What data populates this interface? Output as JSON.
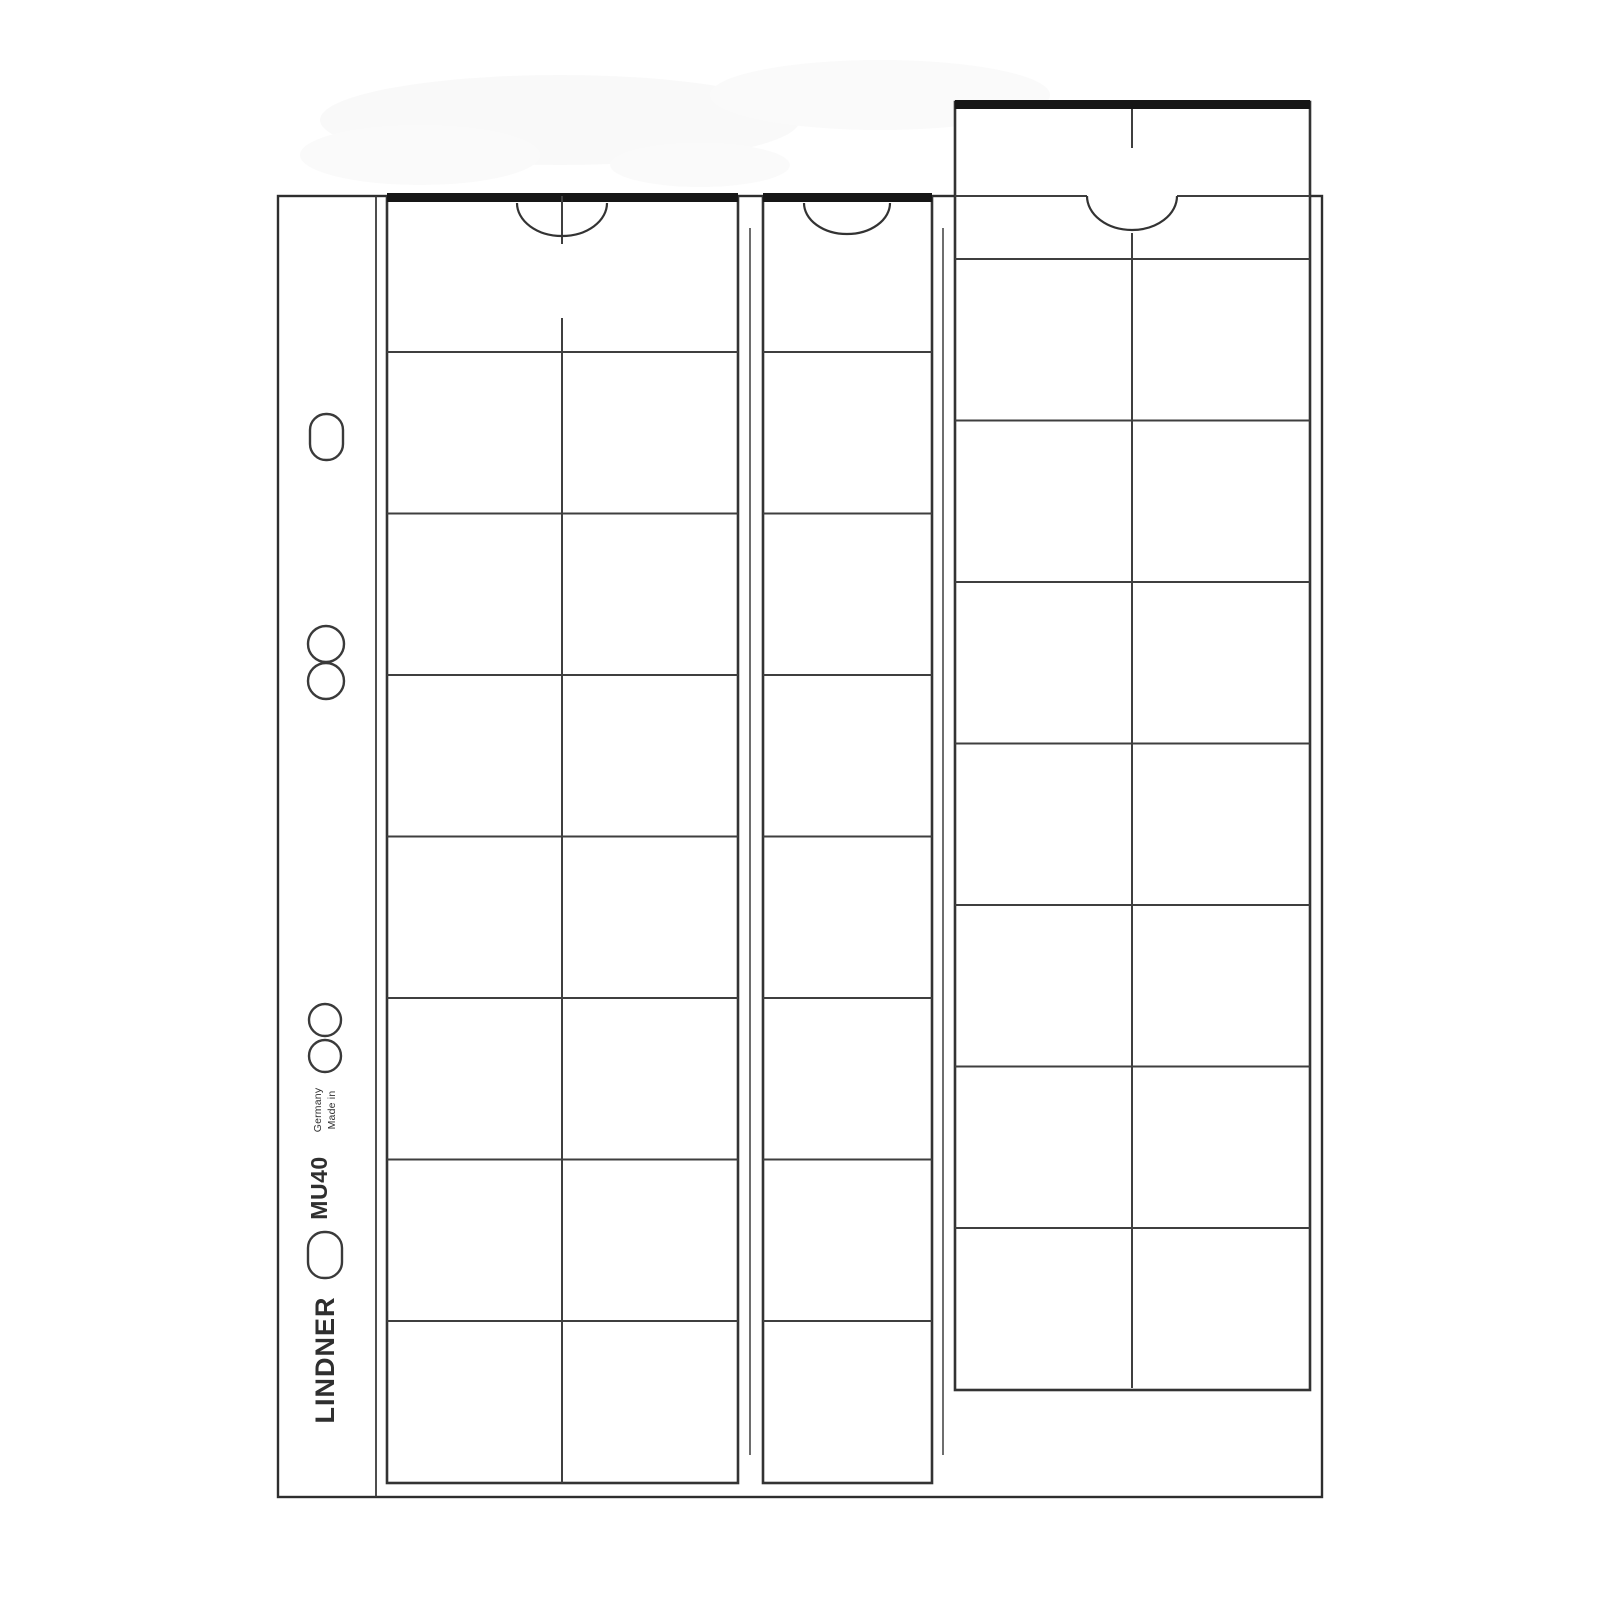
{
  "product": {
    "brand": "LINDNER",
    "model": "MU40",
    "origin": {
      "line1": "Made in",
      "line2": "Germany"
    }
  },
  "drawing": {
    "line_color": "#333333",
    "bar_color": "#161616",
    "page_color": "#ffffff",
    "strips_visible": 3,
    "rows_per_strip": 8
  }
}
